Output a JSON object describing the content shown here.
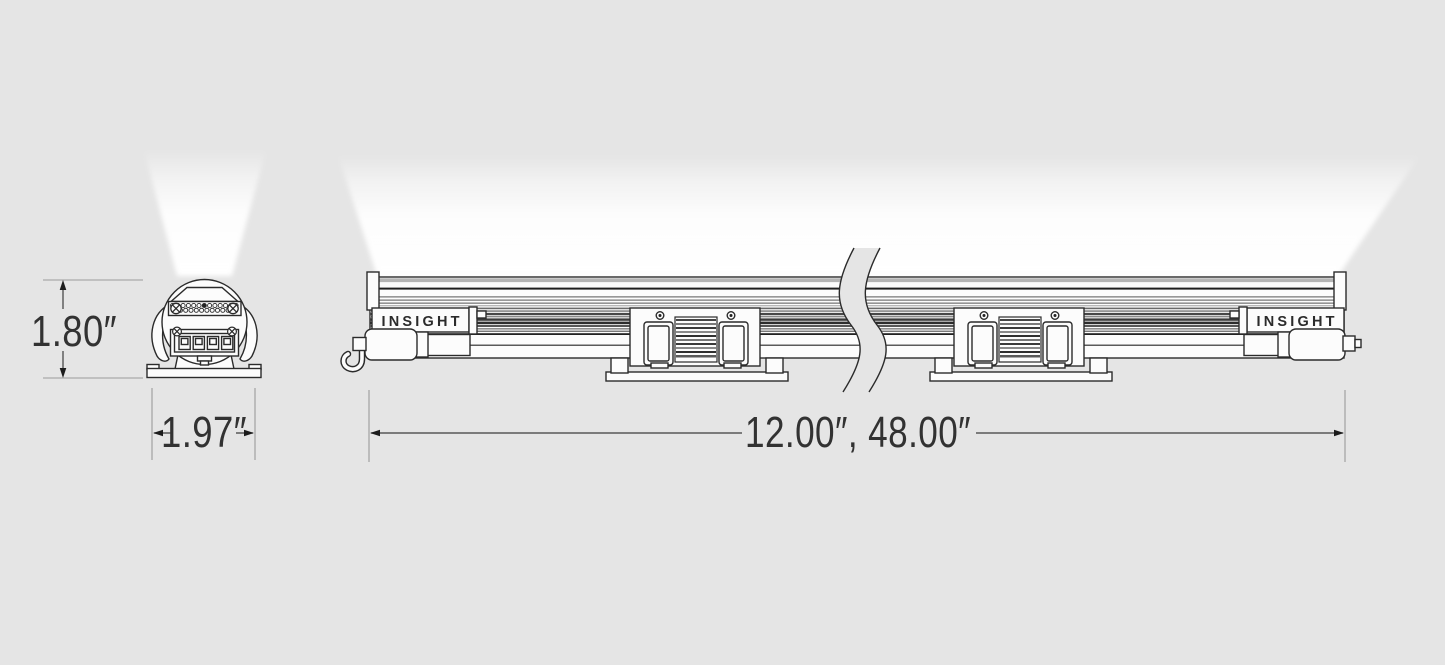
{
  "diagram": {
    "brand": "INSIGHT",
    "colors": {
      "background": "#e5e5e5",
      "line": "#2b2b2b",
      "fill": "#fcfcfc",
      "beam": "#ffffff"
    },
    "end_view": {
      "height_dim": "1.80″",
      "width_dim": "1.97″"
    },
    "side_view": {
      "length_dim": "12.00″, 48.00″",
      "left_endcap": "INSIGHT",
      "right_endcap": "INSIGHT"
    }
  }
}
